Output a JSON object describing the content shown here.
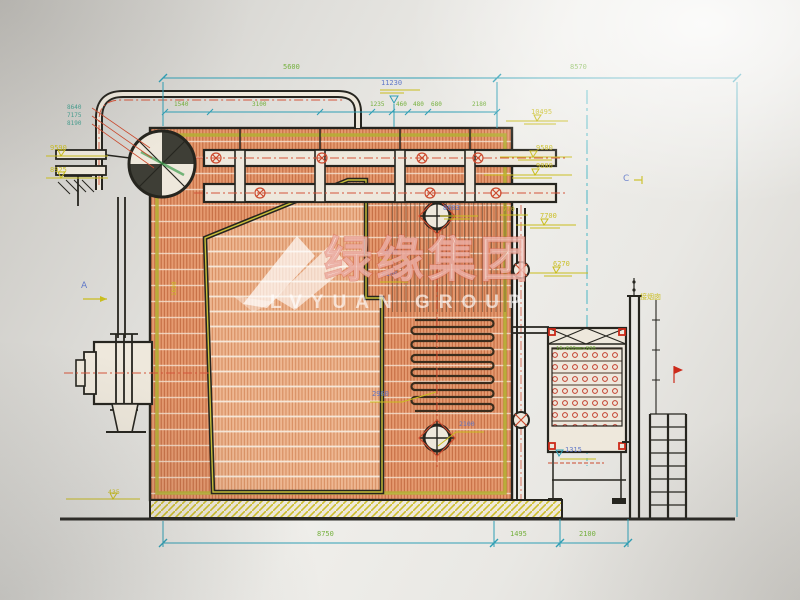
{
  "drawing": {
    "kind": "boiler side-section engineering drawing (photographed blueprint)",
    "dims": {
      "top5600": "5600",
      "top8570": "8570",
      "overall11230": "11230",
      "small": [
        "1540",
        "3100",
        "1235",
        "460",
        "480",
        "680",
        "2180"
      ],
      "stack": [
        "8640",
        "7175",
        "8190"
      ],
      "left9590": "9590",
      "left8925": "8925",
      "left435": "435",
      "wall1600": "1600",
      "right10495": "10495",
      "right9580": "9580",
      "right9080": "9080",
      "right770": "770",
      "right7700": "7700",
      "right6270": "6270",
      "mid8603": "8603",
      "mid5620": "5620",
      "mid6100": "6100",
      "mid2960": "2960",
      "mid2100": "2100",
      "mid1315": "1315",
      "bottom8750": "8750",
      "bottom1495": "1495",
      "bottom2100": "2100"
    },
    "labels": {
      "section_a": "A",
      "section_c": "C",
      "flue": "接烟囱",
      "eco_spec": "16×600mm×800"
    },
    "watermark": {
      "cn": "绿缘集团",
      "en": "LVYUAN GROUP"
    },
    "colors": {
      "hatch_orange": "#e59a70",
      "line_black": "#26251f",
      "dim_teal": "#2f9fb5",
      "text_green": "#6fae35",
      "text_yellow": "#c9bd1d",
      "text_blue": "#5b74c8",
      "accent_red": "#cc4a2e",
      "lining_olive": "#b5ae35"
    }
  }
}
